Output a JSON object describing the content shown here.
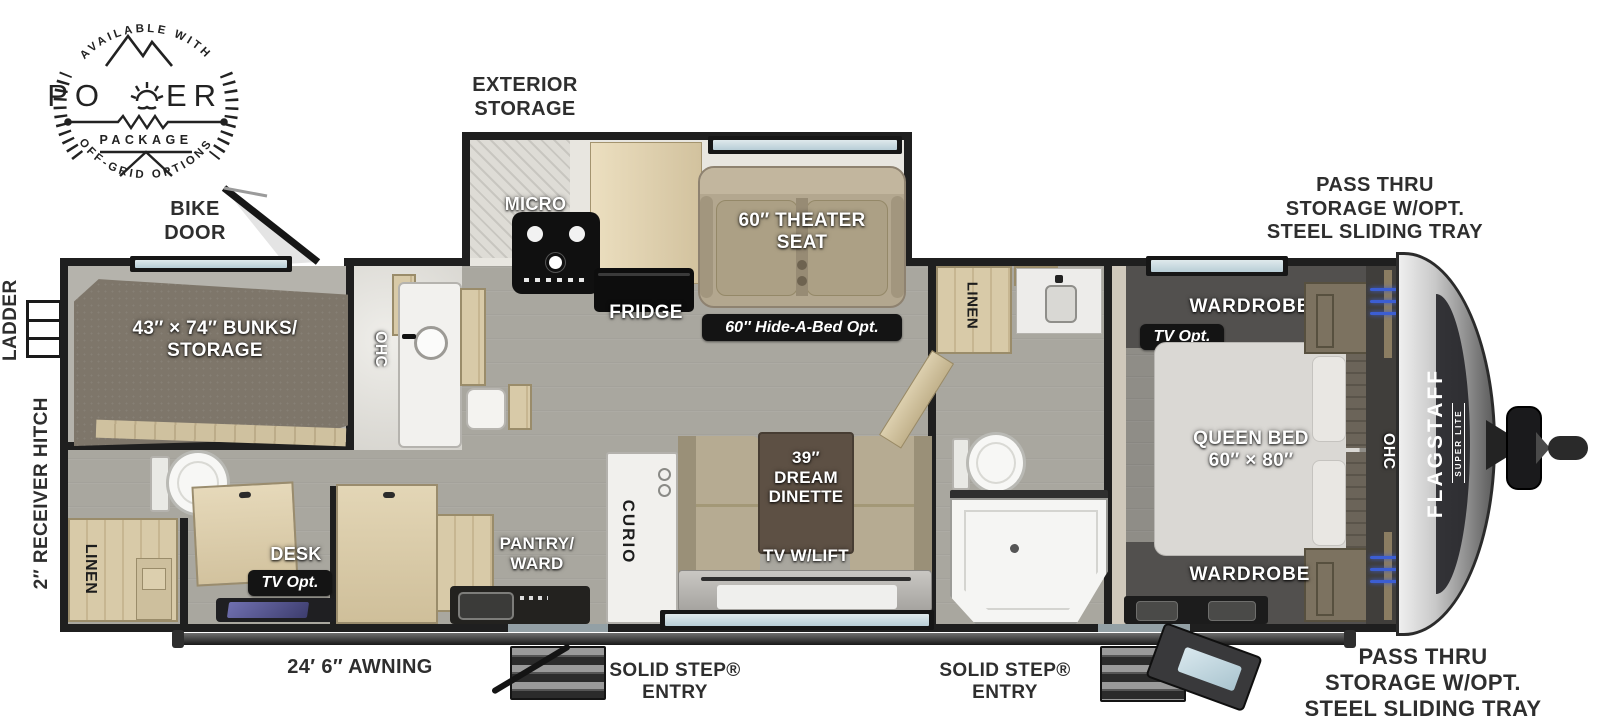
{
  "logo": {
    "top_arc": "AVAILABLE WITH",
    "title_left": "PO",
    "title_right": "ER",
    "subtitle": "PACKAGE",
    "bottom_arc": "OFF-GRID OPTIONS"
  },
  "exterior": {
    "bike_door": "BIKE\nDOOR",
    "exterior_storage": "EXTERIOR\nSTORAGE",
    "pass_thru_top": "PASS THRU\nSTORAGE W/OPT.\nSTEEL SLIDING TRAY",
    "pass_thru_bottom": "PASS THRU\nSTORAGE W/OPT.\nSTEEL SLIDING TRAY",
    "ladder": "LADDER",
    "receiver_hitch": "2″ RECEIVER HITCH",
    "awning": "24′ 6″ AWNING",
    "entry_mid": "SOLID STEP®\nENTRY",
    "entry_front": "SOLID STEP®\nENTRY"
  },
  "brand": {
    "name": "FLAGSTAFF",
    "series": "SUPER LITE"
  },
  "rooms": {
    "bunks": "43″ × 74″ BUNKS/\nSTORAGE",
    "ohc_rear": "OHC",
    "linen_rear": "LINEN",
    "desk": "DESK",
    "tv_opt_rear": "TV Opt.",
    "micro": "MICRO",
    "fridge": "FRIDGE",
    "theater_seat": "60″ THEATER\nSEAT",
    "hide_a_bed": "60″ Hide-A-Bed Opt.",
    "pantry": "PANTRY/\nWARD",
    "curio": "CURIO",
    "dinette": "39″\nDREAM\nDINETTE",
    "tv_lift": "TV W/LIFT",
    "linen_mid": "LINEN",
    "wardrobe_front_top": "WARDROBE",
    "tv_opt_front": "TV Opt.",
    "queen_bed": "QUEEN BED\n60″ × 80″",
    "ohc_front": "OHC",
    "wardrobe_front_bottom": "WARDROBE"
  },
  "colors": {
    "wall": "#1f1f1f",
    "floor": "#a9a79f",
    "led_accent": "#3c5ed2",
    "badge_bg": "#141414",
    "cap_silver": "#c9c9c9",
    "wood_light": "#d8caa8",
    "seat_tan": "#b3a78f",
    "table_brown": "#5d5044",
    "bed_gray": "#dad8d4"
  }
}
